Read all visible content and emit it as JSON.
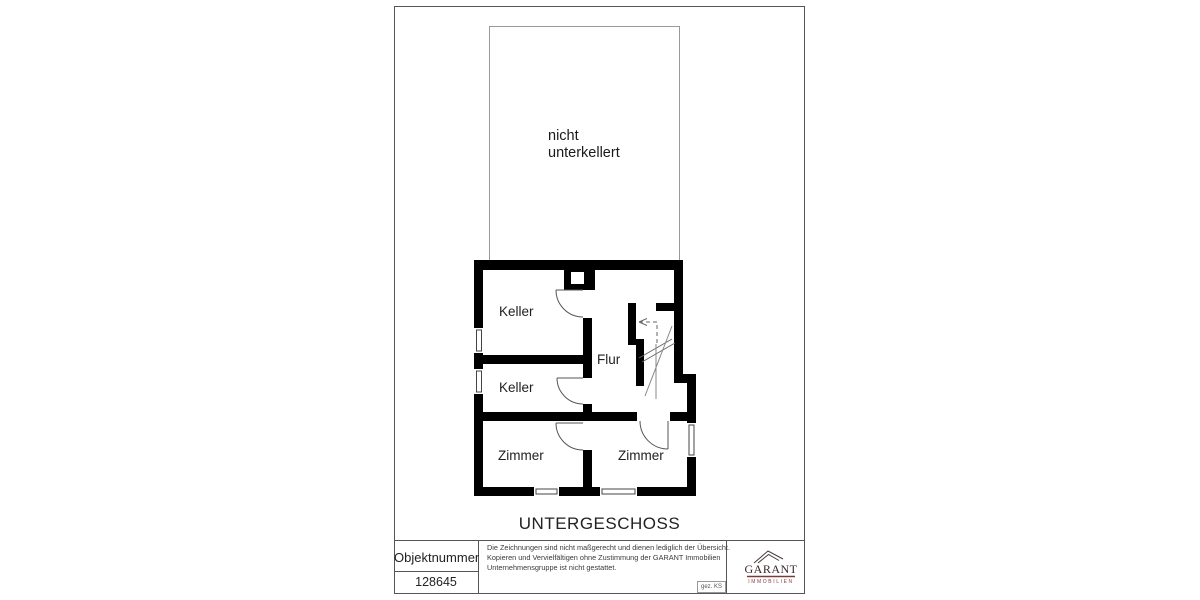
{
  "floor_plan": {
    "floor_title": "UNTERGESCHOSS",
    "area_label": "nicht unterkellert",
    "rooms": [
      {
        "label": "Keller"
      },
      {
        "label": "Keller"
      },
      {
        "label": "Flur"
      },
      {
        "label": "Zimmer"
      },
      {
        "label": "Zimmer"
      }
    ]
  },
  "title_block": {
    "object_number_label": "Objektnummer",
    "object_number": "128645",
    "disclaimer_lines": [
      "Die Zeichnungen sind nicht maßgerecht und dienen lediglich der Übersicht.",
      "Kopieren und Vervielfältigen ohne Zustimmung der GARANT Immobilien",
      "Unternehmensgruppe ist nicht gestattet."
    ],
    "signature": "gez. KS",
    "logo": {
      "brand": "GARANT",
      "tagline": "IMMOBILIEN"
    }
  },
  "colors": {
    "wall": "#000000",
    "thin_line": "#555555",
    "logo_text": "#3a262a",
    "logo_accent": "#7d3a3a"
  }
}
